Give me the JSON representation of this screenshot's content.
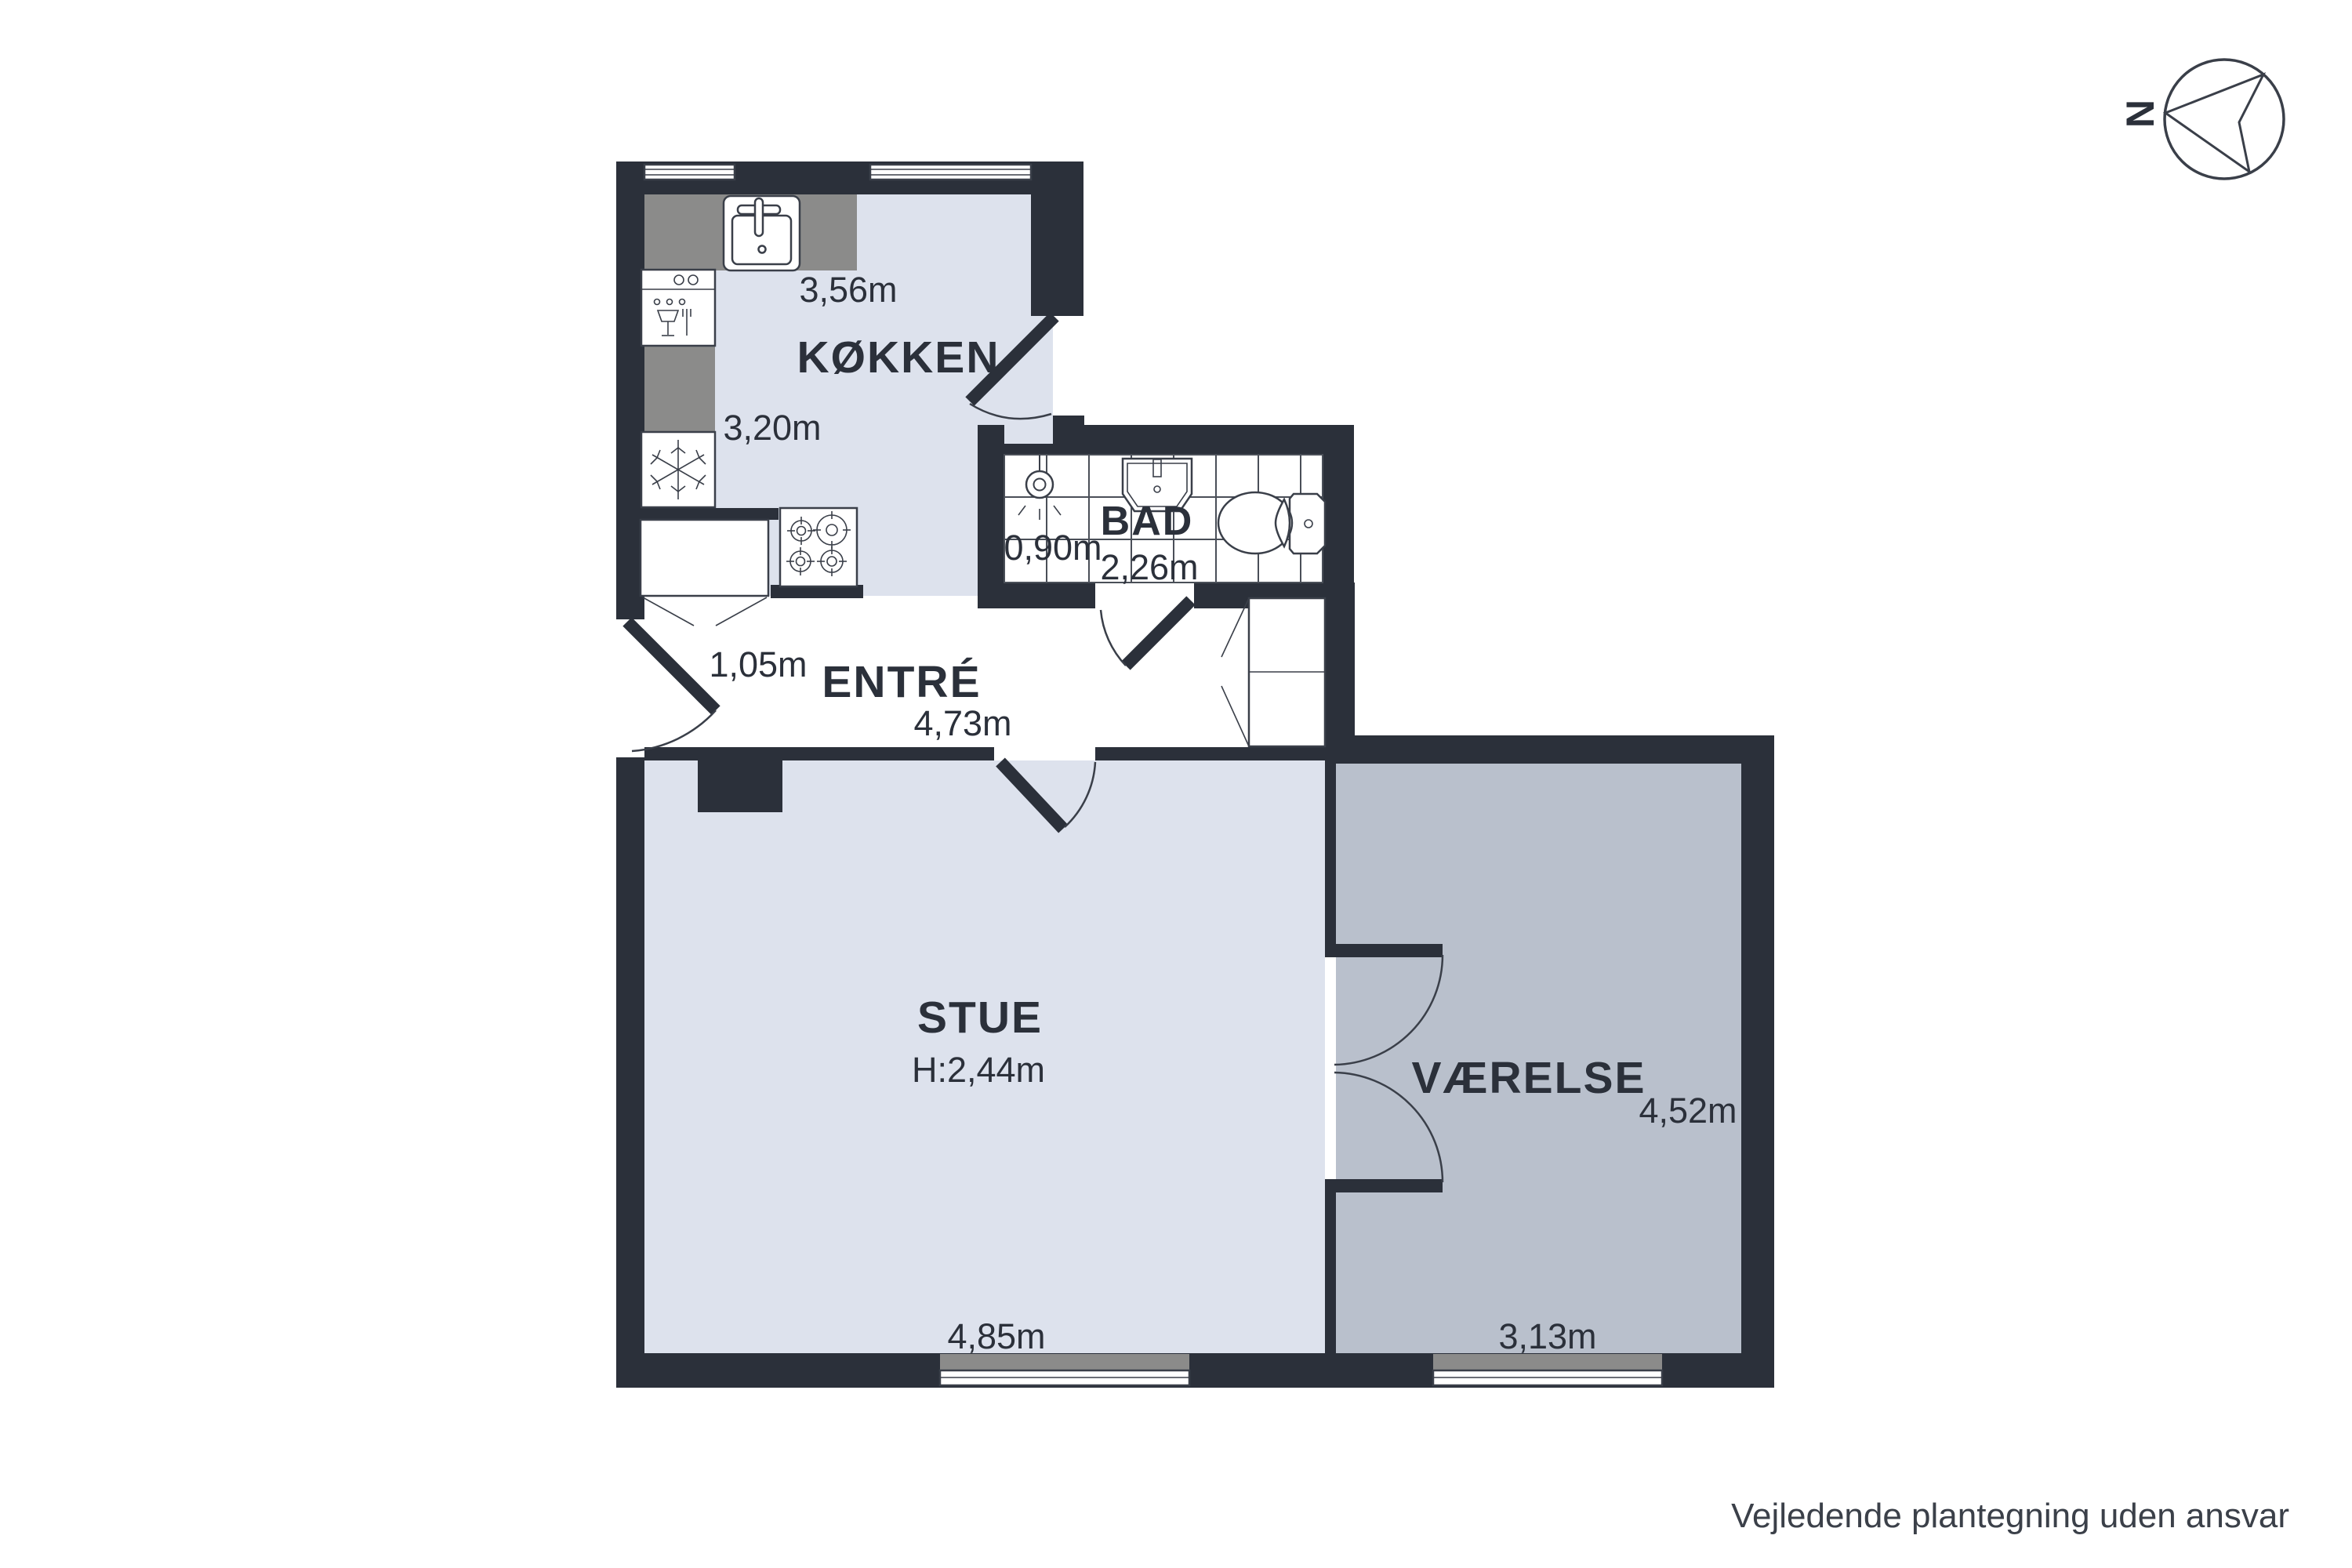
{
  "disclaimer": "Vejledende plantegning uden ansvar",
  "compass": {
    "north_label": "N"
  },
  "rooms": {
    "kokken": {
      "label": "KØKKEN",
      "dim_width": "3,56m",
      "dim_depth": "3,20m"
    },
    "bad": {
      "label": "BAD",
      "dim_depth": "0,90m",
      "dim_width": "2,26m"
    },
    "entre": {
      "label": "ENTRÉ",
      "dim_door": "1,05m",
      "dim_width": "4,73m"
    },
    "stue": {
      "label": "STUE",
      "dim_ceiling": "H:2,44m",
      "dim_width": "4,85m"
    },
    "vaerelse": {
      "label": "VÆRELSE",
      "dim_depth": "4,52m",
      "dim_width": "3,13m"
    }
  },
  "icons": {
    "compass-icon": "circle with arrow pointing to north (left)",
    "sink-icon": "kitchen sink with faucet",
    "dishwasher-icon": "dishwasher with glass and fork",
    "freezer-icon": "snowflake",
    "stove-icon": "four burners",
    "shower-icon": "ceiling shower with spray",
    "washbasin-icon": "bathroom washbasin",
    "toilet-icon": "toilet with cistern",
    "wardrobe-icon": "closet with swing doors"
  },
  "colors": {
    "wall": "#2b303a",
    "floor_light": "#dde2ed",
    "floor_gray": "#b9c0cc",
    "counter_gray": "#8b8b8a",
    "line": "#3a3f49",
    "text": "#2b303a",
    "background": "#ffffff"
  }
}
